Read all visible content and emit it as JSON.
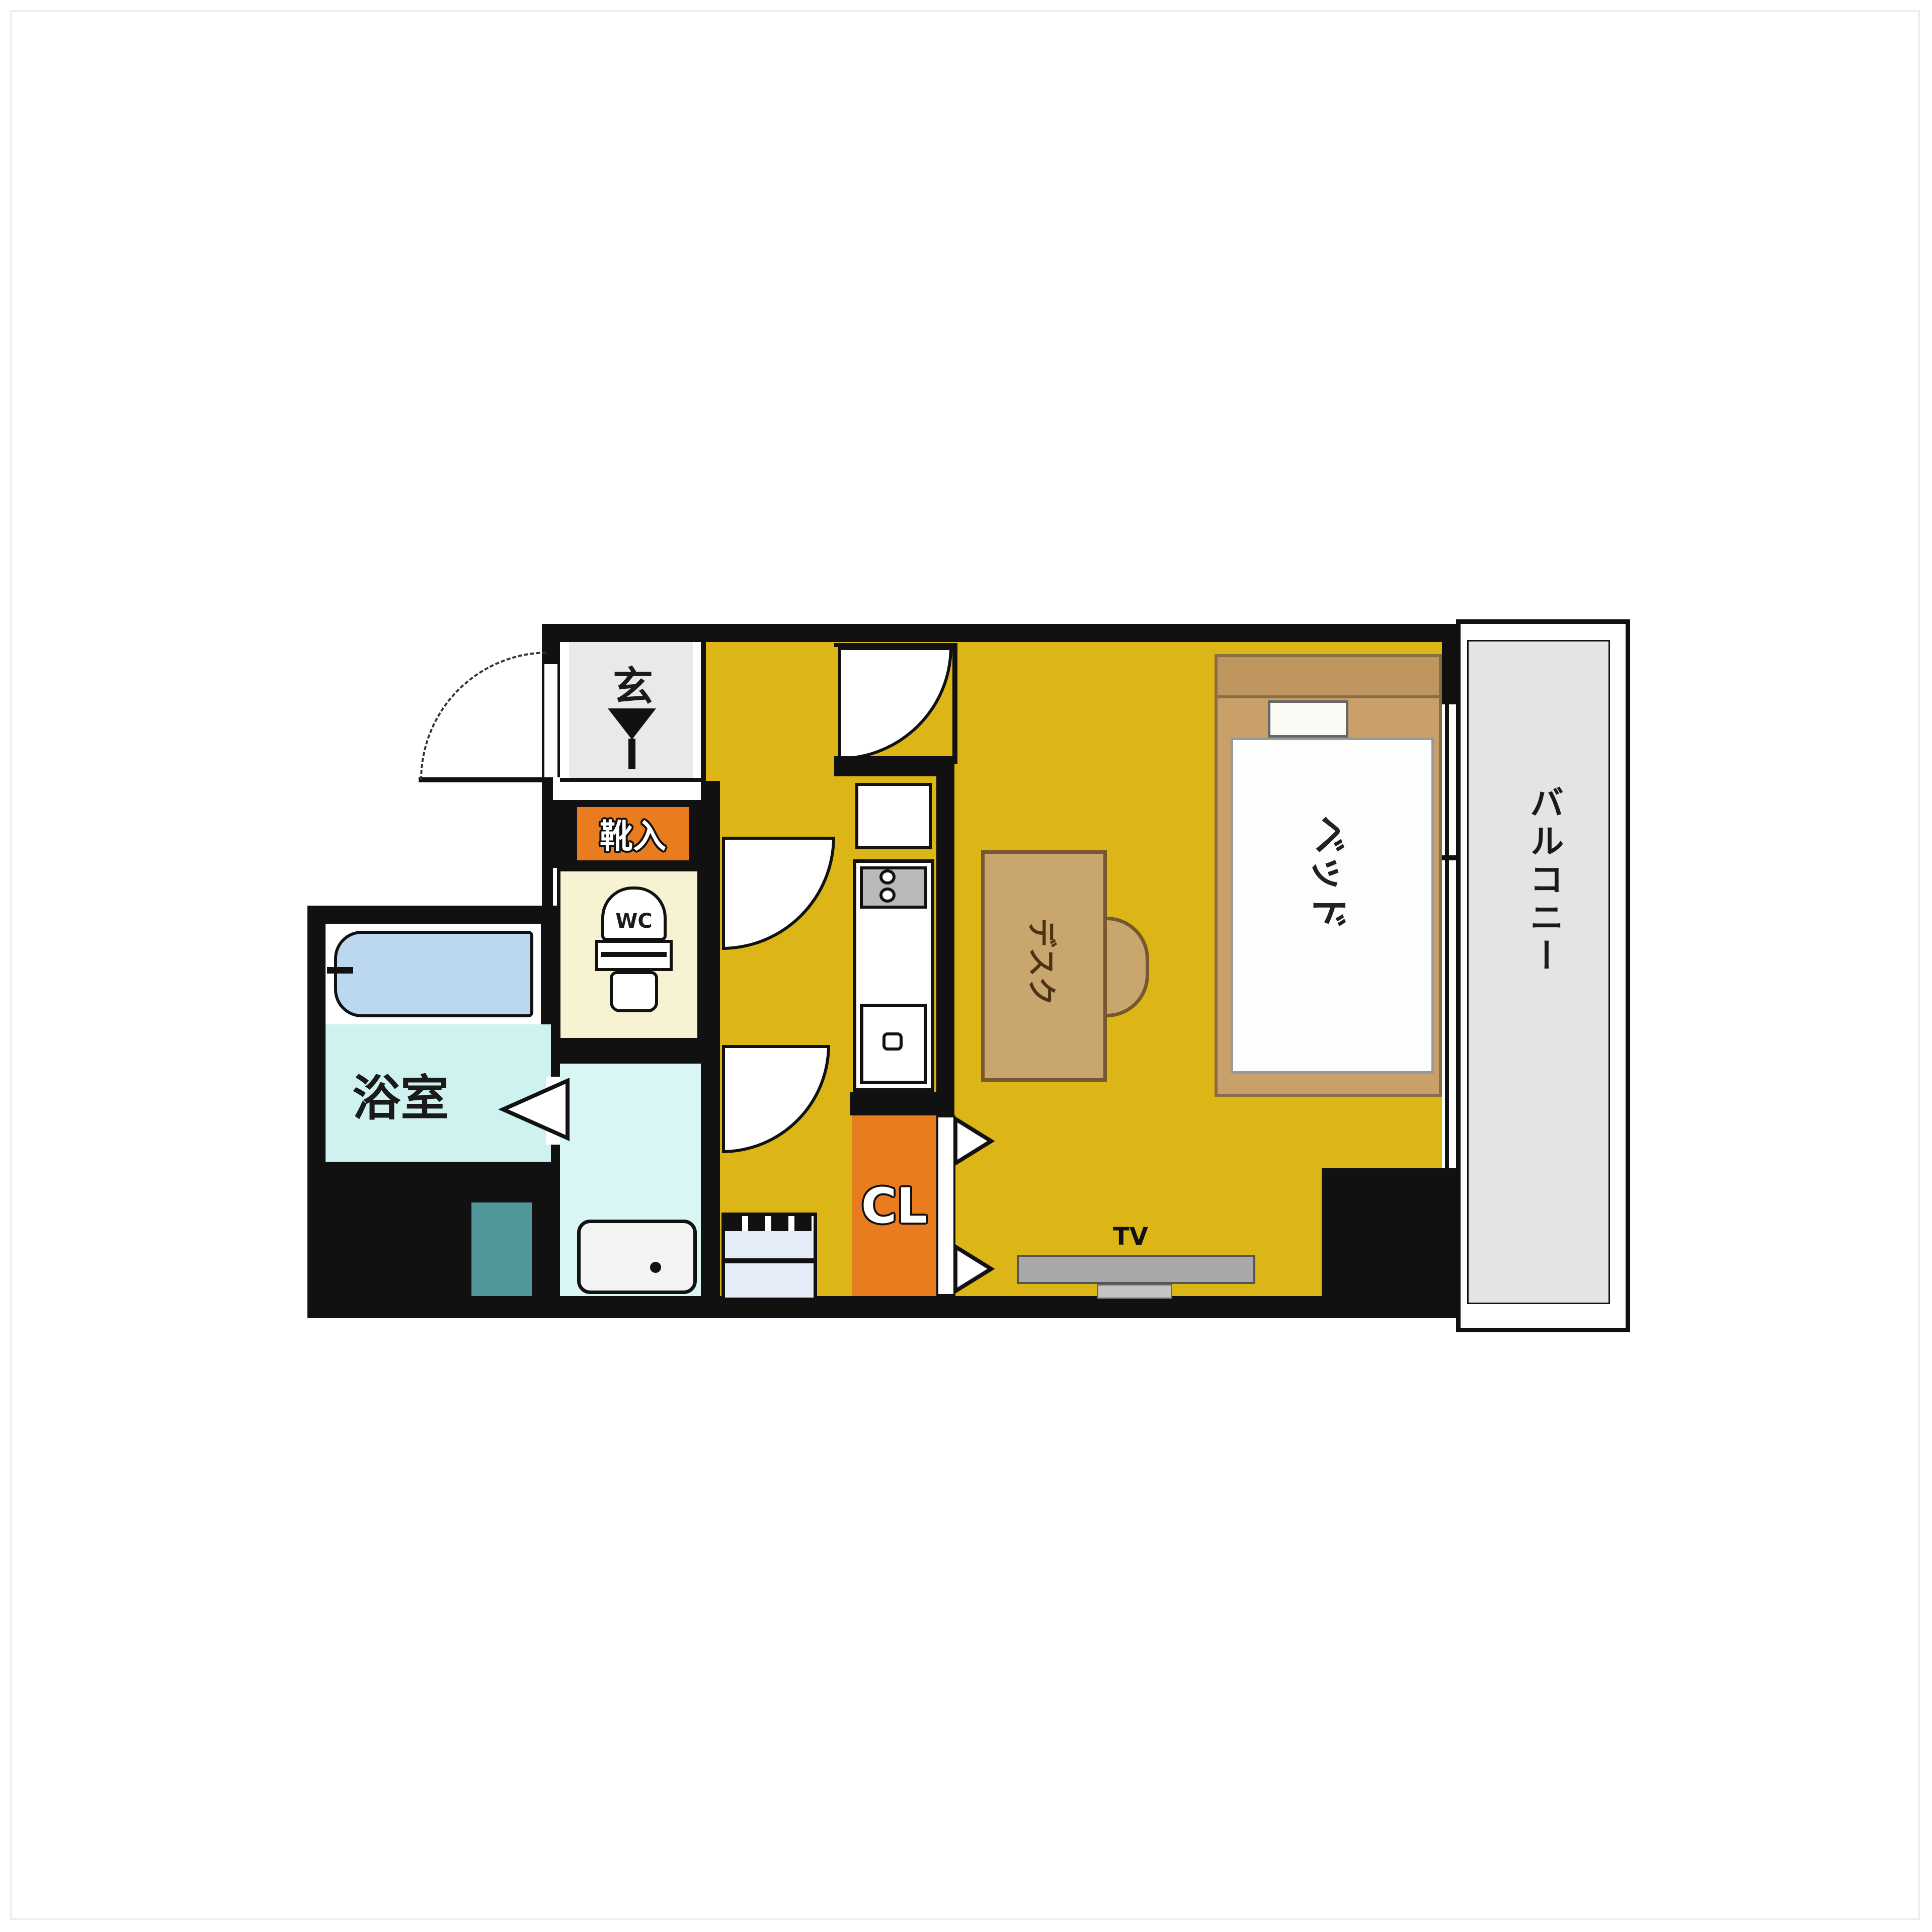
{
  "floorplan": {
    "rooms": {
      "entrance_label": "玄",
      "shoe_cabinet_label": "靴入",
      "toilet_label": "WC",
      "bathroom_label": "浴室",
      "closet_label": "CL",
      "balcony_label": "バルコニー"
    },
    "furniture": {
      "desk_label": "デスク",
      "bed_label": "ベッド",
      "tv_label": "TV"
    },
    "colors": {
      "floor_yellow": "#dcb516",
      "closet_orange": "#e87c1e",
      "shoe_cabinet_orange": "#e87c1e",
      "bathroom_floor_cyan": "#cdf2f0",
      "washroom_cyan": "#d9f6f4",
      "wc_cream": "#f6f2d2",
      "entrance_gray": "#e9e9e9",
      "balcony_gray": "#e4e4e4",
      "bathtub_blue": "#bcd8f0",
      "counter_teal": "#4f9798",
      "furniture_tan": "#c9a66e",
      "bed_frame_tan": "#c9a06a",
      "wall_black": "#111111",
      "tv_gray": "#a8a8a8"
    }
  }
}
